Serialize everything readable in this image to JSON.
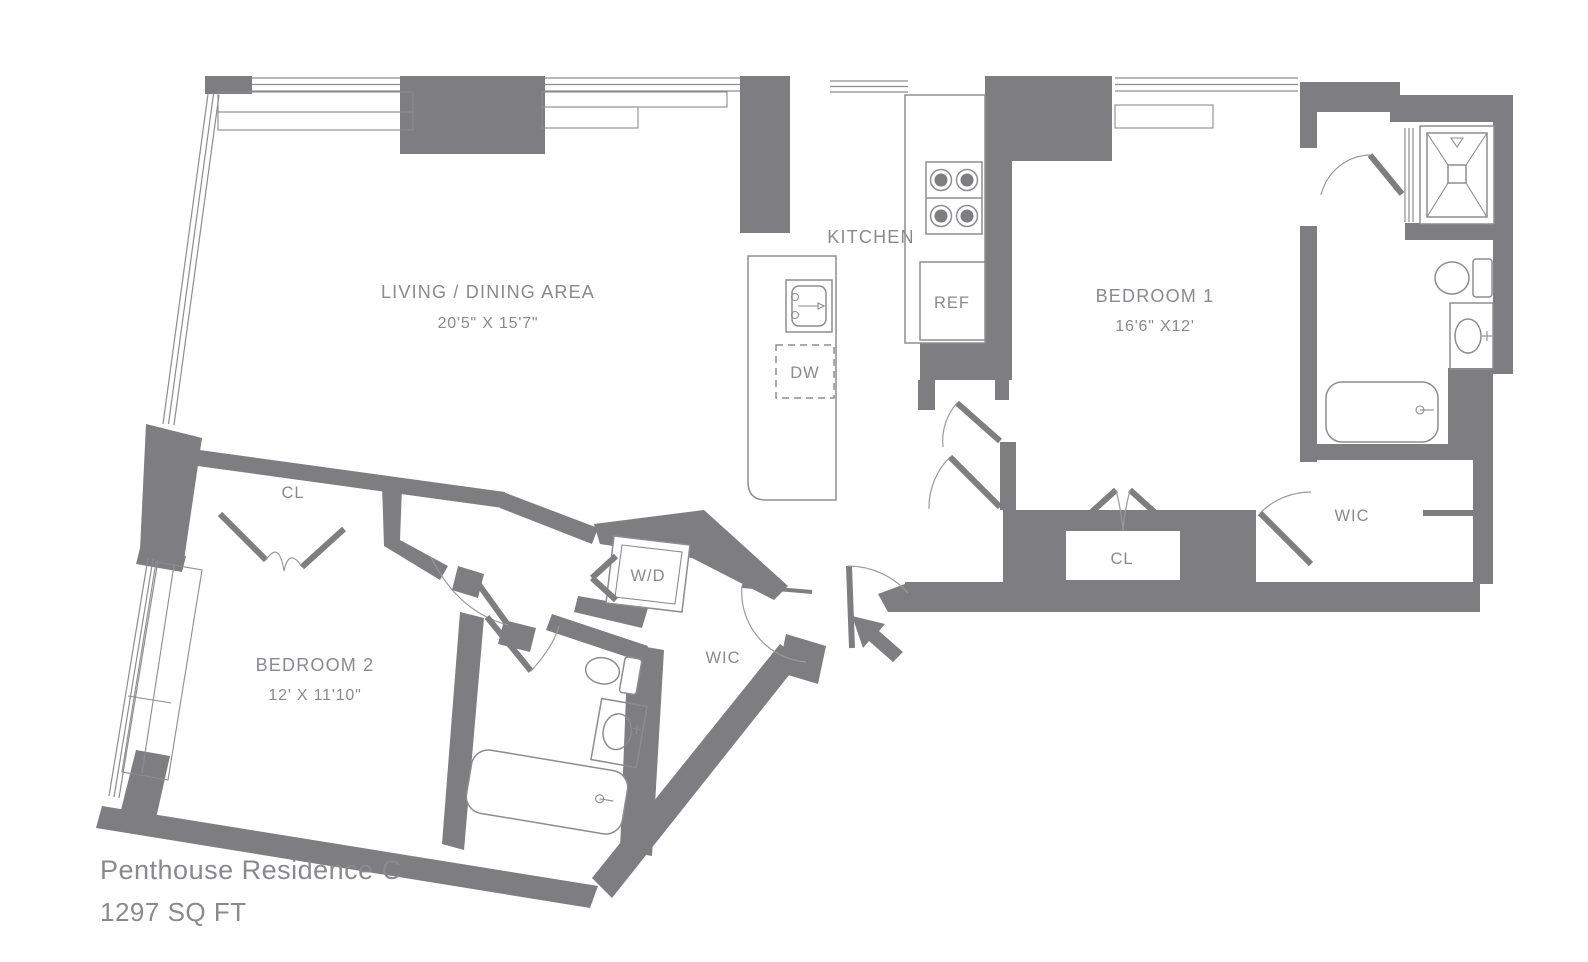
{
  "plan": {
    "title": "Penthouse Residence C",
    "area_label": "1297 SQ FT",
    "colors": {
      "wall": "#7d7d82",
      "line": "#8d8d91",
      "text": "#8a8a8e"
    },
    "rooms": {
      "living": {
        "label": "LIVING / DINING AREA",
        "dims": "20'5\" X 15'7\""
      },
      "kitchen": {
        "label": "KITCHEN"
      },
      "bedroom1": {
        "label": "BEDROOM 1",
        "dims": "16'6\" X12'"
      },
      "bedroom2": {
        "label": "BEDROOM 2",
        "dims": "12' X 11'10\""
      },
      "wic_primary": {
        "label": "WIC"
      },
      "wic_hall": {
        "label": "WIC"
      },
      "closet_bedroom1": {
        "label": "CL"
      },
      "closet_bedroom2": {
        "label": "CL"
      }
    },
    "appliances": {
      "refrigerator": {
        "label": "REF"
      },
      "dishwasher": {
        "label": "DW"
      },
      "washer_dryer": {
        "label": "W/D"
      }
    }
  }
}
